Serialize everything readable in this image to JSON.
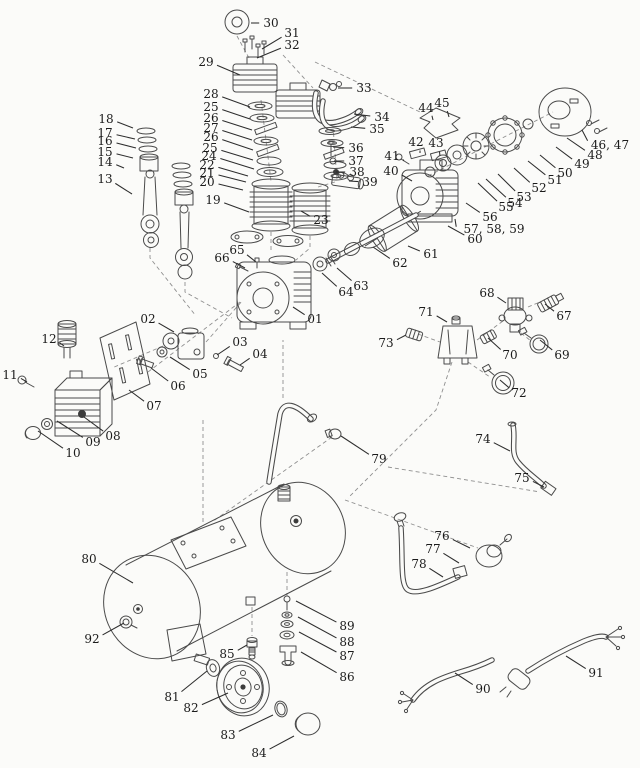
{
  "diagram": {
    "kind": "exploded-parts-diagram",
    "subject": "air-compressor",
    "background_color": "#fbfbf9",
    "line_color": "#4a4a4a",
    "label_color": "#1b1b1b",
    "callouts": [
      {
        "n": "30",
        "lx": 271,
        "ly": 23,
        "tx": 251,
        "ty": 23
      },
      {
        "n": "31",
        "lx": 292,
        "ly": 33,
        "tx": 262,
        "ty": 49
      },
      {
        "n": "32",
        "lx": 292,
        "ly": 45,
        "tx": 257,
        "ty": 58
      },
      {
        "n": "29",
        "lx": 206,
        "ly": 62,
        "tx": 240,
        "ty": 75
      },
      {
        "n": "33",
        "lx": 364,
        "ly": 88,
        "tx": 338,
        "ty": 88
      },
      {
        "n": "34",
        "lx": 382,
        "ly": 117,
        "tx": 354,
        "ty": 114
      },
      {
        "n": "35",
        "lx": 377,
        "ly": 129,
        "tx": 351,
        "ty": 127
      },
      {
        "n": "28",
        "lx": 211,
        "ly": 94,
        "tx": 250,
        "ty": 107
      },
      {
        "n": "25",
        "lx": 211,
        "ly": 107,
        "tx": 250,
        "ty": 119
      },
      {
        "n": "26",
        "lx": 211,
        "ly": 118,
        "tx": 252,
        "ty": 130
      },
      {
        "n": "27",
        "lx": 211,
        "ly": 128,
        "tx": 252,
        "ty": 140
      },
      {
        "n": "26",
        "lx": 211,
        "ly": 137,
        "tx": 253,
        "ty": 150
      },
      {
        "n": "25",
        "lx": 210,
        "ly": 148,
        "tx": 253,
        "ty": 160
      },
      {
        "n": "24",
        "lx": 209,
        "ly": 156,
        "tx": 254,
        "ty": 169
      },
      {
        "n": "22",
        "lx": 207,
        "ly": 165,
        "tx": 248,
        "ty": 176
      },
      {
        "n": "21",
        "lx": 207,
        "ly": 173,
        "tx": 246,
        "ty": 182
      },
      {
        "n": "20",
        "lx": 207,
        "ly": 182,
        "tx": 243,
        "ty": 190
      },
      {
        "n": "19",
        "lx": 213,
        "ly": 200,
        "tx": 249,
        "ty": 212
      },
      {
        "n": "18",
        "lx": 106,
        "ly": 119,
        "tx": 133,
        "ty": 128
      },
      {
        "n": "17",
        "lx": 105,
        "ly": 133,
        "tx": 135,
        "ty": 139
      },
      {
        "n": "16",
        "lx": 105,
        "ly": 141,
        "tx": 136,
        "ty": 148
      },
      {
        "n": "15",
        "lx": 105,
        "ly": 152,
        "tx": 133,
        "ty": 158
      },
      {
        "n": "14",
        "lx": 105,
        "ly": 162,
        "tx": 124,
        "ty": 168
      },
      {
        "n": "13",
        "lx": 105,
        "ly": 179,
        "tx": 132,
        "ty": 194
      },
      {
        "n": "23",
        "lx": 321,
        "ly": 220,
        "tx": 301,
        "ty": 211
      },
      {
        "n": "36",
        "lx": 356,
        "ly": 148,
        "tx": 333,
        "ty": 147
      },
      {
        "n": "37",
        "lx": 356,
        "ly": 161,
        "tx": 334,
        "ty": 161
      },
      {
        "n": "38",
        "lx": 357,
        "ly": 172,
        "tx": 336,
        "ty": 172
      },
      {
        "n": "39",
        "lx": 370,
        "ly": 182,
        "tx": 349,
        "ty": 181
      },
      {
        "n": "44",
        "lx": 426,
        "ly": 108,
        "tx": 433,
        "ty": 120
      },
      {
        "n": "45",
        "lx": 442,
        "ly": 103,
        "tx": 449,
        "ty": 117
      },
      {
        "n": "42",
        "lx": 416,
        "ly": 142,
        "tx": 420,
        "ty": 153
      },
      {
        "n": "43",
        "lx": 436,
        "ly": 143,
        "tx": 440,
        "ty": 156
      },
      {
        "n": "41",
        "lx": 392,
        "ly": 156,
        "tx": 404,
        "ty": 161
      },
      {
        "n": "40",
        "lx": 391,
        "ly": 171,
        "tx": 412,
        "ty": 181
      },
      {
        "n": "46, 47",
        "lx": 610,
        "ly": 145,
        "tx": 582,
        "ty": 130
      },
      {
        "n": "48",
        "lx": 595,
        "ly": 155,
        "tx": 567,
        "ty": 138
      },
      {
        "n": "49",
        "lx": 582,
        "ly": 164,
        "tx": 556,
        "ty": 147
      },
      {
        "n": "50",
        "lx": 565,
        "ly": 173,
        "tx": 540,
        "ty": 155
      },
      {
        "n": "51",
        "lx": 555,
        "ly": 180,
        "tx": 528,
        "ty": 161
      },
      {
        "n": "52",
        "lx": 539,
        "ly": 188,
        "tx": 514,
        "ty": 168
      },
      {
        "n": "53",
        "lx": 524,
        "ly": 197,
        "tx": 498,
        "ty": 174
      },
      {
        "n": "54",
        "lx": 515,
        "ly": 203,
        "tx": 486,
        "ty": 179
      },
      {
        "n": "55",
        "lx": 506,
        "ly": 207,
        "tx": 478,
        "ty": 183
      },
      {
        "n": "56",
        "lx": 490,
        "ly": 217,
        "tx": 466,
        "ty": 203
      },
      {
        "n": "57, 58, 59",
        "lx": 494,
        "ly": 229,
        "tx": 455,
        "ty": 219
      },
      {
        "n": "60",
        "lx": 475,
        "ly": 239,
        "tx": 448,
        "ty": 226
      },
      {
        "n": "61",
        "lx": 431,
        "ly": 254,
        "tx": 408,
        "ty": 246
      },
      {
        "n": "62",
        "lx": 400,
        "ly": 263,
        "tx": 373,
        "ty": 247
      },
      {
        "n": "63",
        "lx": 361,
        "ly": 286,
        "tx": 337,
        "ty": 268
      },
      {
        "n": "64",
        "lx": 346,
        "ly": 292,
        "tx": 322,
        "ty": 273
      },
      {
        "n": "65",
        "lx": 237,
        "ly": 250,
        "tx": 256,
        "ty": 262
      },
      {
        "n": "66",
        "lx": 222,
        "ly": 258,
        "tx": 245,
        "ty": 268
      },
      {
        "n": "01",
        "lx": 315,
        "ly": 319,
        "tx": 293,
        "ty": 307
      },
      {
        "n": "02",
        "lx": 148,
        "ly": 319,
        "tx": 174,
        "ty": 332
      },
      {
        "n": "03",
        "lx": 240,
        "ly": 342,
        "tx": 217,
        "ty": 355
      },
      {
        "n": "04",
        "lx": 260,
        "ly": 354,
        "tx": 240,
        "ty": 365
      },
      {
        "n": "05",
        "lx": 200,
        "ly": 374,
        "tx": 170,
        "ty": 357
      },
      {
        "n": "06",
        "lx": 178,
        "ly": 386,
        "tx": 151,
        "ty": 368
      },
      {
        "n": "07",
        "lx": 154,
        "ly": 406,
        "tx": 129,
        "ty": 390
      },
      {
        "n": "08",
        "lx": 113,
        "ly": 436,
        "tx": 84,
        "ty": 417
      },
      {
        "n": "09",
        "lx": 93,
        "ly": 442,
        "tx": 57,
        "ty": 421
      },
      {
        "n": "10",
        "lx": 73,
        "ly": 453,
        "tx": 38,
        "ty": 431
      },
      {
        "n": "11",
        "lx": 10,
        "ly": 375,
        "tx": 27,
        "ty": 382
      },
      {
        "n": "12",
        "lx": 49,
        "ly": 339,
        "tx": 64,
        "ty": 346
      },
      {
        "n": "68",
        "lx": 487,
        "ly": 293,
        "tx": 506,
        "ty": 303
      },
      {
        "n": "67",
        "lx": 564,
        "ly": 316,
        "tx": 545,
        "ty": 304
      },
      {
        "n": "71",
        "lx": 426,
        "ly": 312,
        "tx": 447,
        "ty": 322
      },
      {
        "n": "73",
        "lx": 386,
        "ly": 343,
        "tx": 406,
        "ty": 335
      },
      {
        "n": "70",
        "lx": 510,
        "ly": 355,
        "tx": 488,
        "ty": 338
      },
      {
        "n": "69",
        "lx": 562,
        "ly": 355,
        "tx": 540,
        "ty": 340
      },
      {
        "n": "72",
        "lx": 519,
        "ly": 393,
        "tx": 500,
        "ty": 380
      },
      {
        "n": "79",
        "lx": 379,
        "ly": 459,
        "tx": 341,
        "ty": 436
      },
      {
        "n": "74",
        "lx": 483,
        "ly": 439,
        "tx": 510,
        "ty": 451
      },
      {
        "n": "75",
        "lx": 522,
        "ly": 478,
        "tx": 544,
        "ty": 487
      },
      {
        "n": "76",
        "lx": 442,
        "ly": 536,
        "tx": 470,
        "ty": 548
      },
      {
        "n": "77",
        "lx": 433,
        "ly": 549,
        "tx": 459,
        "ty": 563
      },
      {
        "n": "78",
        "lx": 419,
        "ly": 564,
        "tx": 443,
        "ty": 577
      },
      {
        "n": "80",
        "lx": 89,
        "ly": 559,
        "tx": 133,
        "ty": 583
      },
      {
        "n": "92",
        "lx": 92,
        "ly": 639,
        "tx": 124,
        "ty": 623
      },
      {
        "n": "85",
        "lx": 227,
        "ly": 654,
        "tx": 247,
        "ty": 645
      },
      {
        "n": "81",
        "lx": 172,
        "ly": 697,
        "tx": 207,
        "ty": 671
      },
      {
        "n": "82",
        "lx": 191,
        "ly": 708,
        "tx": 228,
        "ty": 693
      },
      {
        "n": "83",
        "lx": 228,
        "ly": 735,
        "tx": 273,
        "ty": 715
      },
      {
        "n": "84",
        "lx": 259,
        "ly": 753,
        "tx": 294,
        "ty": 736
      },
      {
        "n": "89",
        "lx": 347,
        "ly": 626,
        "tx": 296,
        "ty": 601
      },
      {
        "n": "88",
        "lx": 347,
        "ly": 642,
        "tx": 298,
        "ty": 617
      },
      {
        "n": "87",
        "lx": 347,
        "ly": 656,
        "tx": 299,
        "ty": 632
      },
      {
        "n": "86",
        "lx": 347,
        "ly": 677,
        "tx": 301,
        "ty": 652
      },
      {
        "n": "90",
        "lx": 483,
        "ly": 689,
        "tx": 455,
        "ty": 673
      },
      {
        "n": "91",
        "lx": 596,
        "ly": 673,
        "tx": 566,
        "ty": 656
      }
    ]
  }
}
